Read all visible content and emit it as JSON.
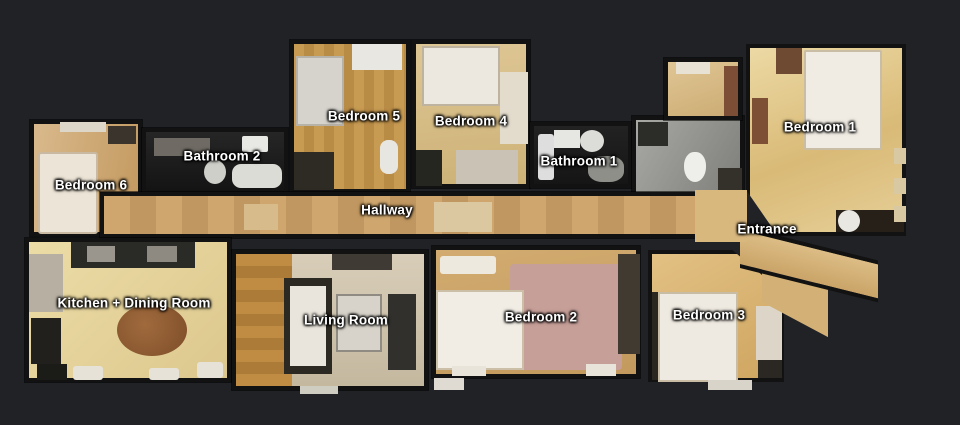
{
  "view": {
    "kind": "3d-scan-floorplan-top-view",
    "background": "#212226"
  },
  "palette": {
    "wall": "#121212",
    "wood_amber": "#c59a55",
    "wood_light": "#dcc490",
    "floor_pale": "#e7d6a6",
    "bed_white": "#efeae2",
    "rug_pink": "#c79f99",
    "tile_gray": "#9a9a9a",
    "fixture_dark": "#1d1d1d",
    "table_brown": "#8a5a35",
    "label_text": "#ffffff"
  },
  "rooms": [
    {
      "id": "bedroom-6",
      "label": "Bedroom 6"
    },
    {
      "id": "bathroom-2",
      "label": "Bathroom 2"
    },
    {
      "id": "bedroom-5",
      "label": "Bedroom 5"
    },
    {
      "id": "bedroom-4",
      "label": "Bedroom 4"
    },
    {
      "id": "bathroom-1",
      "label": "Bathroom 1"
    },
    {
      "id": "bedroom-1",
      "label": "Bedroom 1"
    },
    {
      "id": "hallway",
      "label": "Hallway"
    },
    {
      "id": "entrance",
      "label": "Entrance"
    },
    {
      "id": "kitchen-dining",
      "label": "Kitchen + Dining Room"
    },
    {
      "id": "living-room",
      "label": "Living Room"
    },
    {
      "id": "bedroom-2",
      "label": "Bedroom 2"
    },
    {
      "id": "bedroom-3",
      "label": "Bedroom 3"
    }
  ]
}
